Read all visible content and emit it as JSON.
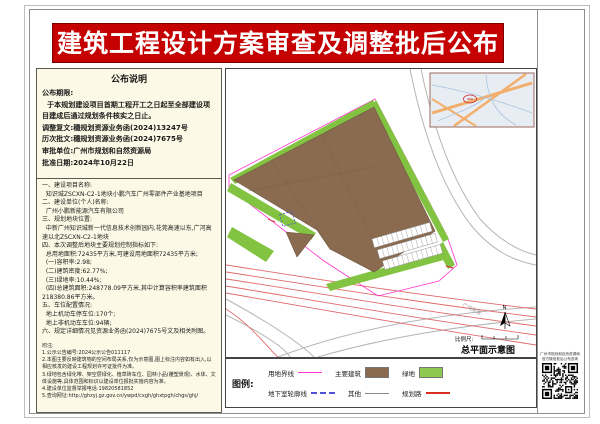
{
  "title": "建筑工程设计方案审查及调整批后公布",
  "notice": {
    "header": "公布说明",
    "top_lines": [
      "公布期限:",
      "  于本规划建设项目首期工程开工之日起至全部建设项目建成后通过规划条件核实之日止。",
      "调整复文:穗规划资源业务函(2024)13247号",
      "历次批文:穗规划资源业务函(2024)7675号",
      "审批单位:广州市规划和自然资源局",
      "批准日期:2024年10月22日"
    ],
    "body_lines": [
      "一、建设项目名称:",
      "  知识城ZSCXN-C2-1地块小鹏汽车广州零部件产业基地项目",
      "二、建设单位(个人)名称:",
      "  广州小鹏新能源汽车有限公司",
      "三、规划地块位置:",
      "  中新广州知识城新一代信息技术创新园内,花莞高速以东,广河高速以北ZSCXN-C2-1地块",
      "四、本次调整后地块主要规划控制指标如下:",
      "  总用地面积:72435平方米,可建设用地面积72435平方米;",
      "  (一)容积率:2.98;",
      "  (二)建筑密度:62.77%;",
      "  (三)绿地率:10.44%;",
      "  (四)总建筑面积:248778.09平方米,其中计算容积率建筑面积218380.86平方米。",
      "五、车位配置情况:",
      "  地上机动车停车位:170个;",
      "  地上非机动车车位:94辆;",
      "六、规定详细情况见资源业务函(2024)7675号文及相关附图。"
    ],
    "notes_lines": [
      "附注:",
      "1.公示公告编号:2024公示公告011117",
      "2.本图主要反映建筑物的空间布局关系,仅为示意图,图上标注内容如有出入,以相应核发的建设工程规划许可证批件为准。",
      "3.绿地包含绿化带、架空层绿化、植草砖车位、园林小品(雕塑景观)、水体、文体设施等,具体范围和标识以建设单位报批实施内容为准。",
      "4.建设单位监督举报电话:19820581852",
      "5.查询网址:http://ghzyj.gz.gov.cn/ywpd/cxgh/ghxtpgh/chgs/ghj/"
    ]
  },
  "map": {
    "caption": "总平面示意图",
    "scale_label": "比例尺:",
    "north_label": "N",
    "road_label": "广河高速"
  },
  "legend": {
    "title": "图例:",
    "items": [
      {
        "label": "用地界线",
        "swatch": "boundary-line",
        "color": "#ff33cc"
      },
      {
        "label": "主要建筑",
        "swatch": "building-box",
        "color": "#8a6b50"
      },
      {
        "label": "绿地",
        "swatch": "green-box",
        "color": "#8cc94e"
      },
      {
        "label": "地下室轮廓线",
        "swatch": "dashed-line",
        "color": "#5050d8"
      },
      {
        "label": "其他",
        "swatch": "other-line",
        "color": "#8a8a8a"
      },
      {
        "label": "规划路",
        "swatch": "road-line",
        "color": "#d93025"
      }
    ]
  },
  "qr": {
    "caption_line1": "广州市规划和自然资源局",
    "caption_line2": "官方微信批后公布查询"
  },
  "colors": {
    "banner_red": "#c40000",
    "panel_cream": "#fcfae6",
    "building_brown": "#8a6b50",
    "green_space": "#82c341",
    "site_boundary_magenta": "#ff33cc",
    "planned_road_red": "#d93025",
    "basement_blue": "#5050d8",
    "other_road_gray": "#b5b5b5"
  }
}
